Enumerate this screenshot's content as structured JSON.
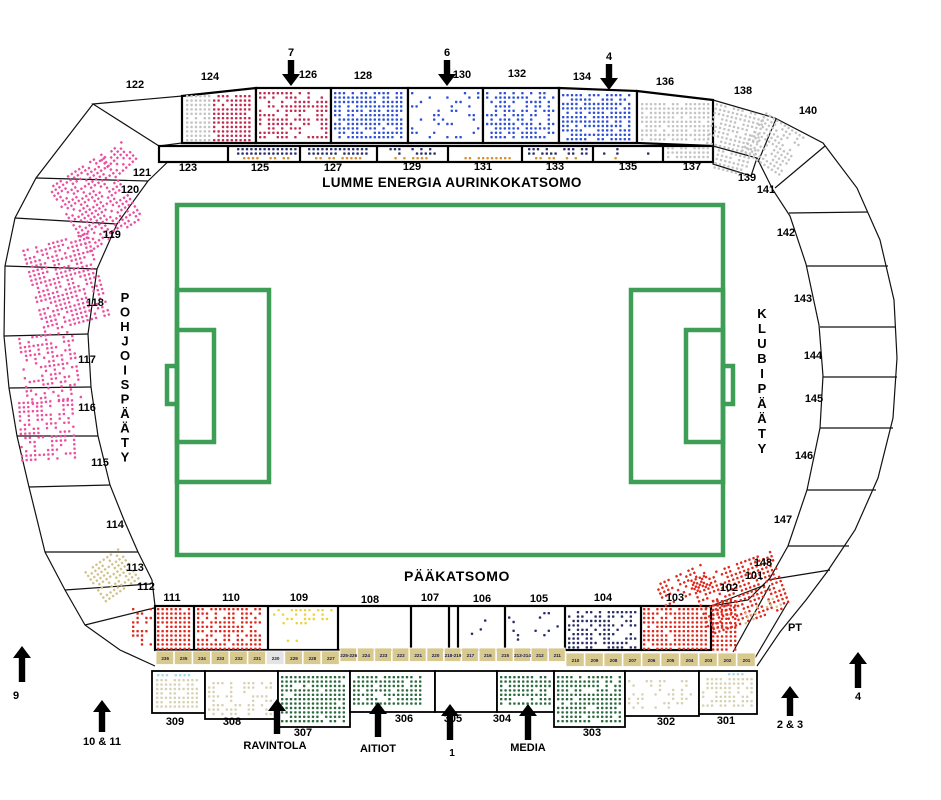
{
  "colors": {
    "pitch": "#3F9E56",
    "seat_red": "#E1281C",
    "seat_crimson": "#C02B50",
    "seat_blue": "#2F51D6",
    "seat_navy": "#2A2E68",
    "seat_orange": "#D8922F",
    "seat_pink": "#EC4F9F",
    "seat_gray": "#C4C4C4",
    "seat_beige": "#D8D2B5",
    "seat_khaki": "#D2C28C",
    "seat_green": "#2B6B3E",
    "seat_yellow": "#EFD23F",
    "seat_cyan": "#A5DBE8",
    "row_strip_bg": "#D8C98E",
    "row_strip_highlight_bg": "#E4E4E4",
    "outline": "#000000"
  },
  "stands": {
    "sun_stand": {
      "name": "LUMME ENERGIA AURINKOKATSOMO"
    },
    "main_stand": {
      "name": "PÄÄKATSOMO"
    },
    "north_end": {
      "name": "POHJOISPÄÄTY"
    },
    "club_end": {
      "name": "KLUBIPÄÄTY"
    }
  },
  "labels": {
    "pt": "PT"
  },
  "sections": {
    "sun_upper": [
      "122",
      "124",
      "126",
      "128",
      "130",
      "132",
      "134",
      "136",
      "138",
      "140"
    ],
    "sun_lower": [
      "123",
      "125",
      "127",
      "129",
      "131",
      "133",
      "135",
      "137",
      "139"
    ],
    "north_end": [
      "121",
      "120",
      "119",
      "118",
      "117",
      "116",
      "115",
      "114",
      "113",
      "112"
    ],
    "club_end": [
      "141",
      "142",
      "143",
      "144",
      "145",
      "146",
      "147",
      "148"
    ],
    "main": [
      "111",
      "110",
      "109",
      "108",
      "107",
      "106",
      "105",
      "104",
      "103",
      "102",
      "101"
    ],
    "back": [
      "309",
      "308",
      "307",
      "306",
      "305",
      "304",
      "303",
      "302",
      "301"
    ]
  },
  "row_strip": {
    "labels": [
      "236",
      "235",
      "234",
      "233",
      "232",
      "231",
      "230",
      "229",
      "228",
      "227",
      "225-226",
      "224",
      "223",
      "222",
      "221",
      "220",
      "218-219",
      "217",
      "216",
      "215",
      "213-214",
      "212",
      "211",
      "210",
      "209",
      "208",
      "207",
      "206",
      "205",
      "204",
      "203",
      "202",
      "201"
    ],
    "highlighted": "230"
  },
  "gates": [
    {
      "id": "gate-7",
      "label": "7",
      "direction": "down"
    },
    {
      "id": "gate-6",
      "label": "6",
      "direction": "down"
    },
    {
      "id": "gate-4-top",
      "label": "4",
      "direction": "down"
    },
    {
      "id": "gate-9",
      "label": "9",
      "direction": "up"
    },
    {
      "id": "gate-10-11",
      "label": "10 & 11",
      "direction": "up"
    },
    {
      "id": "gate-ravintola",
      "label": "RAVINTOLA",
      "direction": "up"
    },
    {
      "id": "gate-aitiot",
      "label": "AITIOT",
      "direction": "up"
    },
    {
      "id": "gate-1",
      "label": "1",
      "direction": "up"
    },
    {
      "id": "gate-media",
      "label": "MEDIA",
      "direction": "up"
    },
    {
      "id": "gate-2-3",
      "label": "2 & 3",
      "direction": "up"
    },
    {
      "id": "gate-4-right",
      "label": "4",
      "direction": "up"
    }
  ]
}
